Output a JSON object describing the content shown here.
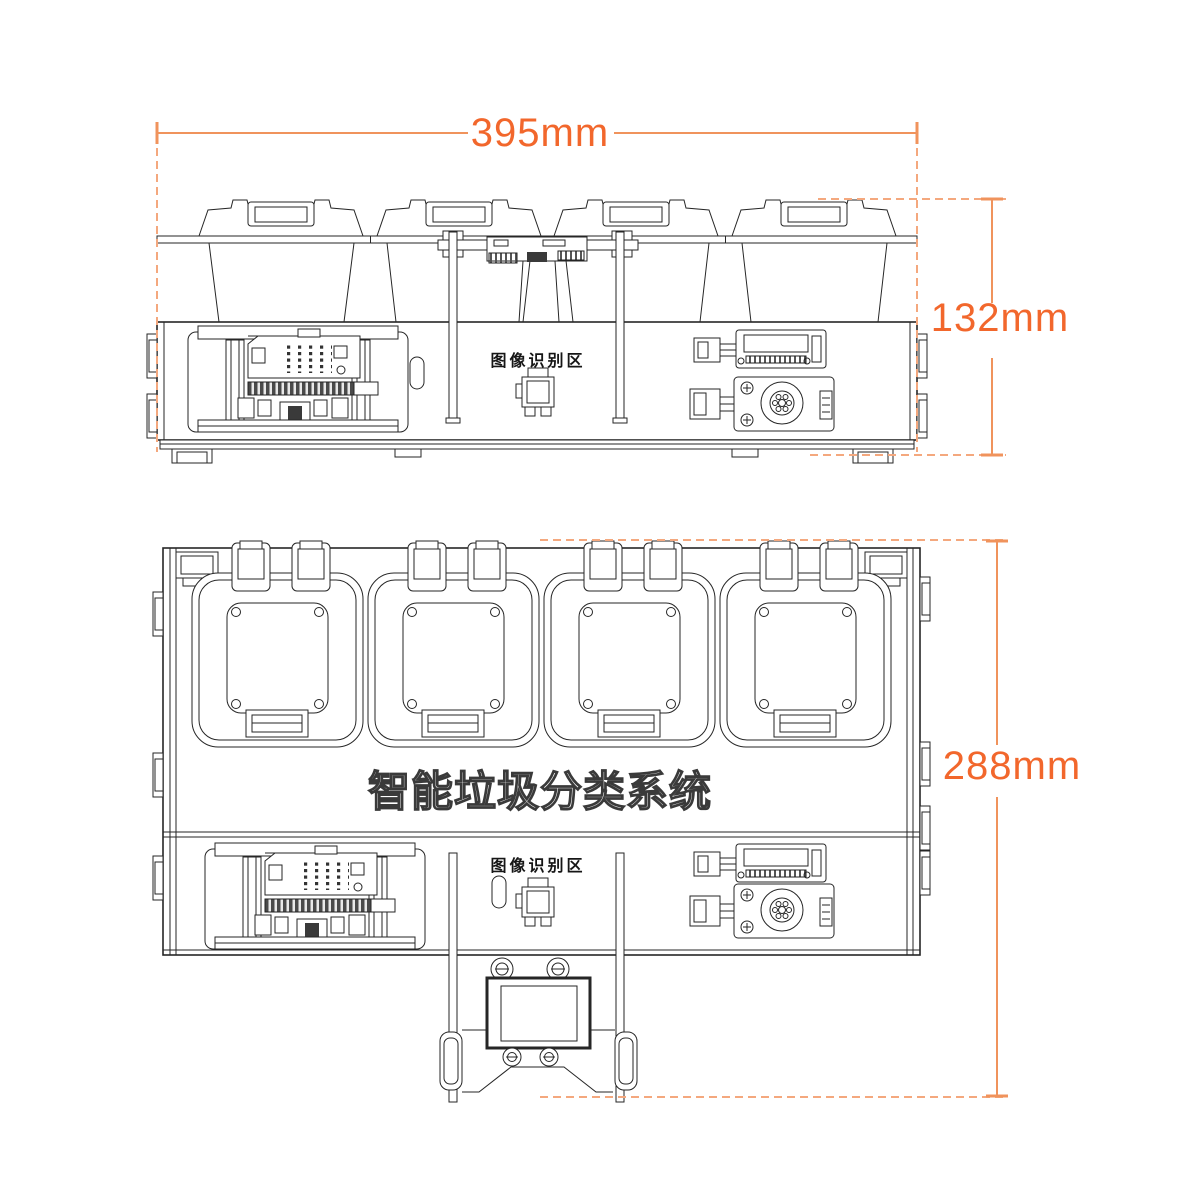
{
  "diagram": {
    "dimensions": {
      "width": {
        "label": "395mm"
      },
      "height": {
        "label": "132mm"
      },
      "depth": {
        "label": "288mm"
      }
    },
    "front_view": {
      "recognition_area_label": "图像识别区"
    },
    "top_view": {
      "system_title": "智能垃圾分类系统",
      "recognition_area_label": "图像识别区"
    },
    "colors": {
      "dimension_text": "#f2672c",
      "dimension_line": "#f0935c",
      "extension_dash": "#f4a87e",
      "line_art": "#262626",
      "background": "#ffffff"
    }
  }
}
